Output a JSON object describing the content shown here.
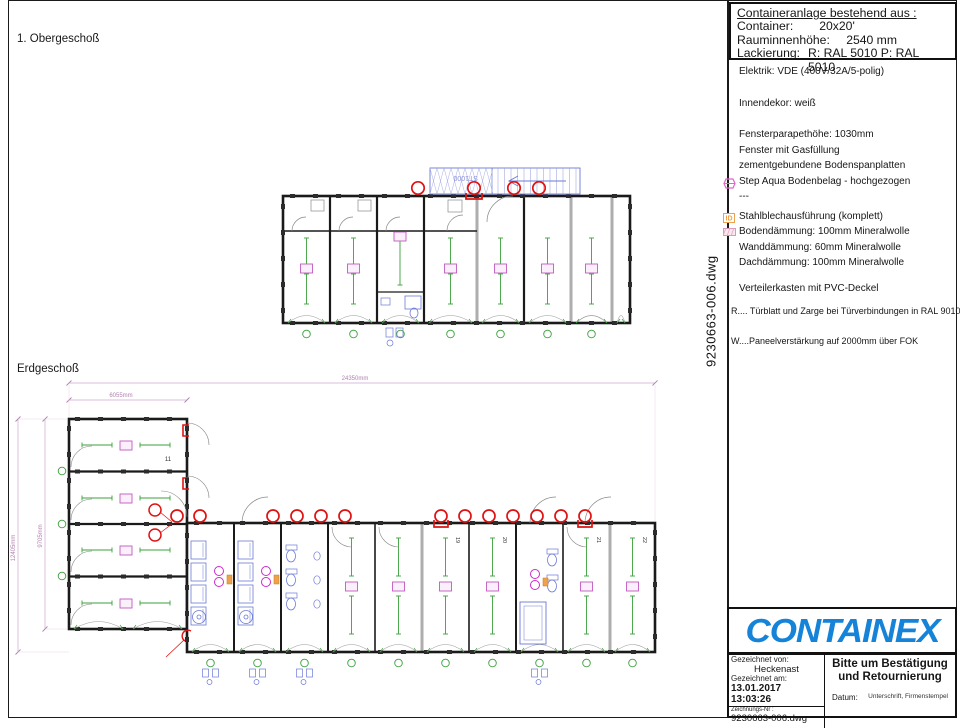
{
  "sheet": {
    "floor_labels": {
      "upper": "1. Obergeschoß",
      "ground": "Erdgeschoß"
    },
    "drawing_file_vertical": "9230663-006.dwg"
  },
  "title_block": {
    "header": "Containeranlage bestehend aus :",
    "rows": [
      {
        "label": "Container:",
        "value": "20x20'"
      },
      {
        "label": "Rauminnenhöhe:",
        "value": "2540 mm"
      },
      {
        "label": "Lackierung:",
        "value": "R: RAL 5010  P: RAL 5010"
      }
    ]
  },
  "specs": {
    "lines": [
      {
        "text": "Elektrik: VDE (400V/32A/5-polig)",
        "icon": ""
      },
      {
        "text": "Innendekor: weiß",
        "icon": ""
      },
      {
        "text": "Fensterparapethöhe: 1030mm",
        "icon": ""
      },
      {
        "text": "Fenster mit Gasfüllung",
        "icon": ""
      },
      {
        "text": "zementgebundene Bodenspanplatten",
        "icon": ""
      },
      {
        "text": "Step Aqua Bodenbelag - hochgezogen",
        "icon": "step-aqua-icon"
      },
      {
        "text": "---",
        "icon": ""
      },
      {
        "text": "Stahlblechausführung (komplett)",
        "icon": "id-icon"
      },
      {
        "text": "Bodendämmung: 100mm Mineralwolle",
        "icon": "insulation-icon"
      },
      {
        "text": "Wanddämmung: 60mm Mineralwolle",
        "icon": ""
      },
      {
        "text": "Dachdämmung: 100mm Mineralwolle",
        "icon": ""
      },
      {
        "text": "Verteilerkasten mit PVC-Deckel",
        "icon": ""
      }
    ],
    "notes": [
      "R.... Türblatt und Zarge bei Türverbindungen in RAL 9010",
      "W....Paneelverstärkung auf 2000mm über FOK"
    ]
  },
  "plan": {
    "stair_label": "ST1000",
    "dims": {
      "total_width": "24350mm",
      "wing_width": "6055mm",
      "wing_height": "9705mm",
      "outer_height": "12405mm"
    },
    "room_numbers": {
      "wing": "11",
      "bay19": "19",
      "bay20": "20",
      "bay21": "21",
      "bay22": "22"
    }
  },
  "footer": {
    "logo": "CONTAINEX",
    "drawn_by_label": "Gezeichnet von:",
    "drawn_by": "Heckenast",
    "drawn_at_label": "Gezeichnet am:",
    "drawn_at": "13.01.2017 13:03:26",
    "drawing_no_label": "Zeichnungs-Nr :",
    "drawing_no": "9230663-006.dwg",
    "request_line1": "Bitte um Bestätigung",
    "request_line2": "und Retournierung",
    "date_label": "Datum:",
    "signature_label": "Unterschrift, Firmenstempel"
  },
  "colors": {
    "brand_blue": "#1583d8",
    "wall": "#1a1a1a",
    "annotation_green": "#3aa03a",
    "marker_red": "#e11212",
    "fixture_blue": "#6b79d6",
    "label_pink": "#c05ac0",
    "dim_pink": "#cfa6cf"
  }
}
